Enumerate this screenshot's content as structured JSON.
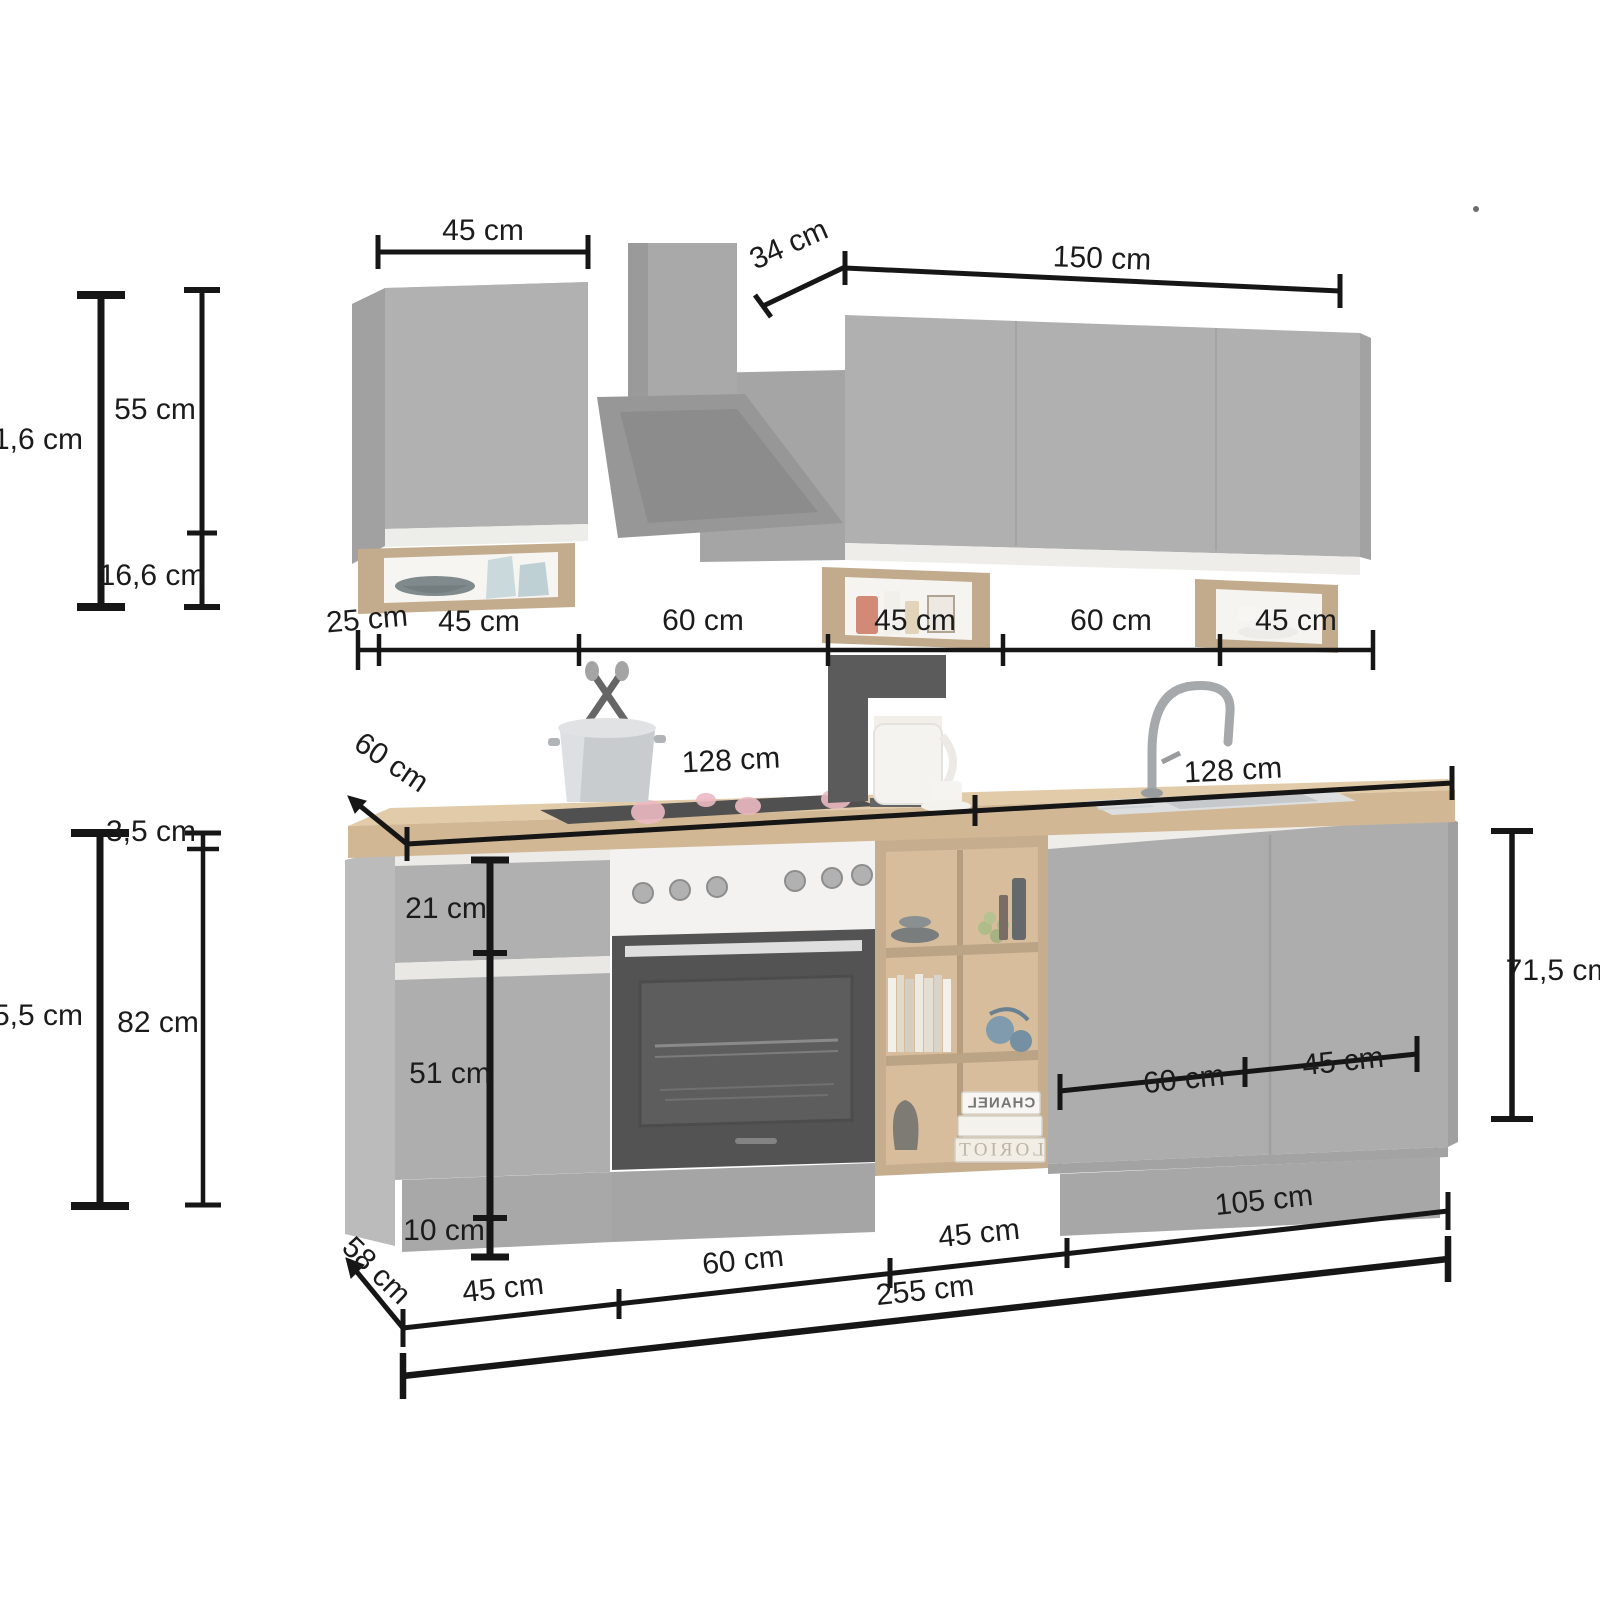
{
  "units": "cm",
  "labels": {
    "upper": {
      "cab_width": "45 cm",
      "hood_depth": "34 cm",
      "right_width": "150 cm",
      "height_overall": "1,6 cm",
      "door_height": "55 cm",
      "shelf_height": "16,6 cm",
      "row": [
        "25 cm",
        "45 cm",
        "60 cm",
        "45 cm",
        "60 cm",
        "45 cm"
      ]
    },
    "counter": {
      "depth": "60 cm",
      "left_width": "128 cm",
      "right_width": "128 cm"
    },
    "base": {
      "worktop_thickness": "3,5 cm",
      "height_overall": "5,5 cm",
      "carcass_height": "82 cm",
      "drawer_height": "21 cm",
      "door_height": "51 cm",
      "plinth_height": "10 cm",
      "right_height": "71,5 cm",
      "door_width_60": "60 cm",
      "door_width_45": "45 cm",
      "depth": "58 cm",
      "row": [
        "45 cm",
        "60 cm",
        "45 cm",
        "105 cm"
      ],
      "total_width": "255 cm"
    },
    "decor": {
      "book_top": "CHANEL",
      "book_bottom": "LORIOT"
    }
  }
}
